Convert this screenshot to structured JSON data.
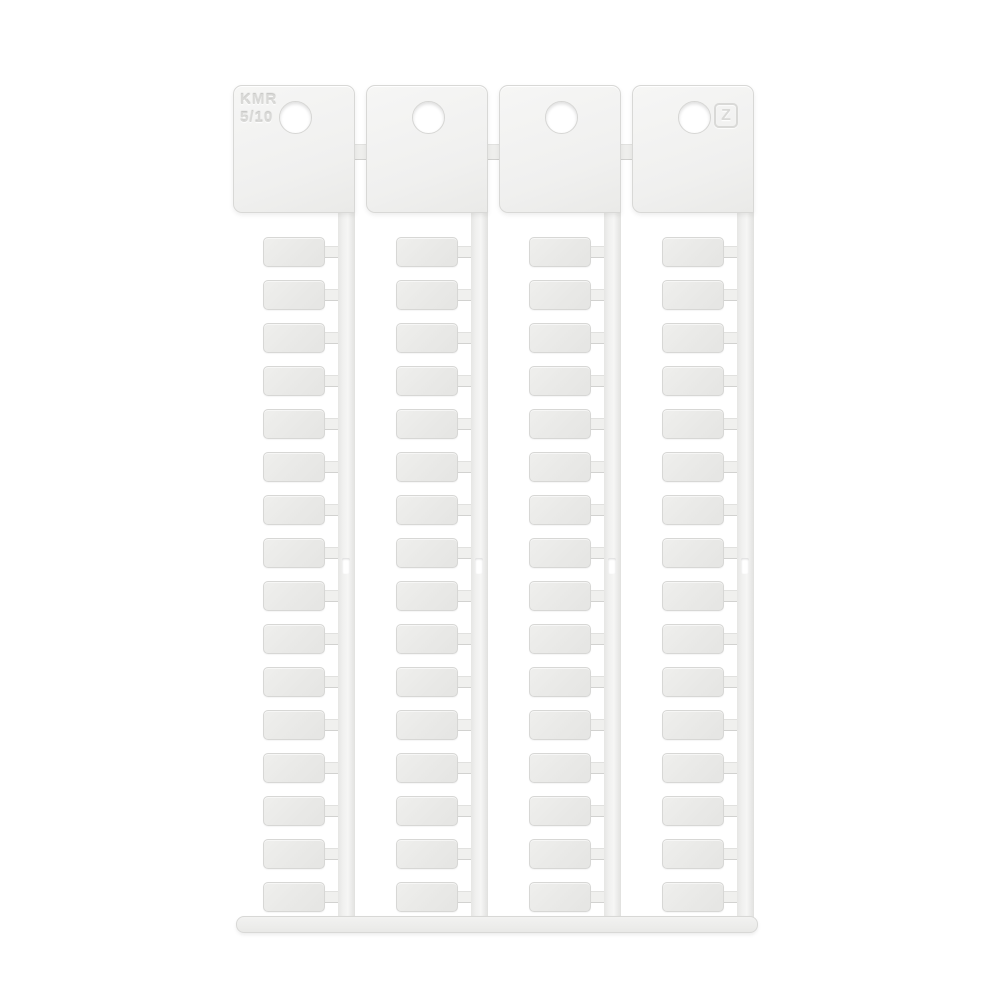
{
  "page": {
    "background_color": "#ffffff",
    "description": "Blank white plastic terminal-block marker card: four snap-off strips on a carrier frame"
  },
  "product": {
    "code_line1": "KMR",
    "code_line2": "5/10",
    "logo_glyph": "Z"
  },
  "sheet": {
    "columns": 4,
    "tags_per_column": 16,
    "total_tags": 64,
    "holes_per_header": 1,
    "slots_per_rail": 1
  },
  "colors": {
    "background": "#ffffff",
    "plastic_face": "#f0f0ef",
    "plastic_light": "#f6f6f5",
    "tag_face": "#e9e9e7",
    "edge": "#d8d8d6",
    "emboss": "#d9d9d7"
  }
}
